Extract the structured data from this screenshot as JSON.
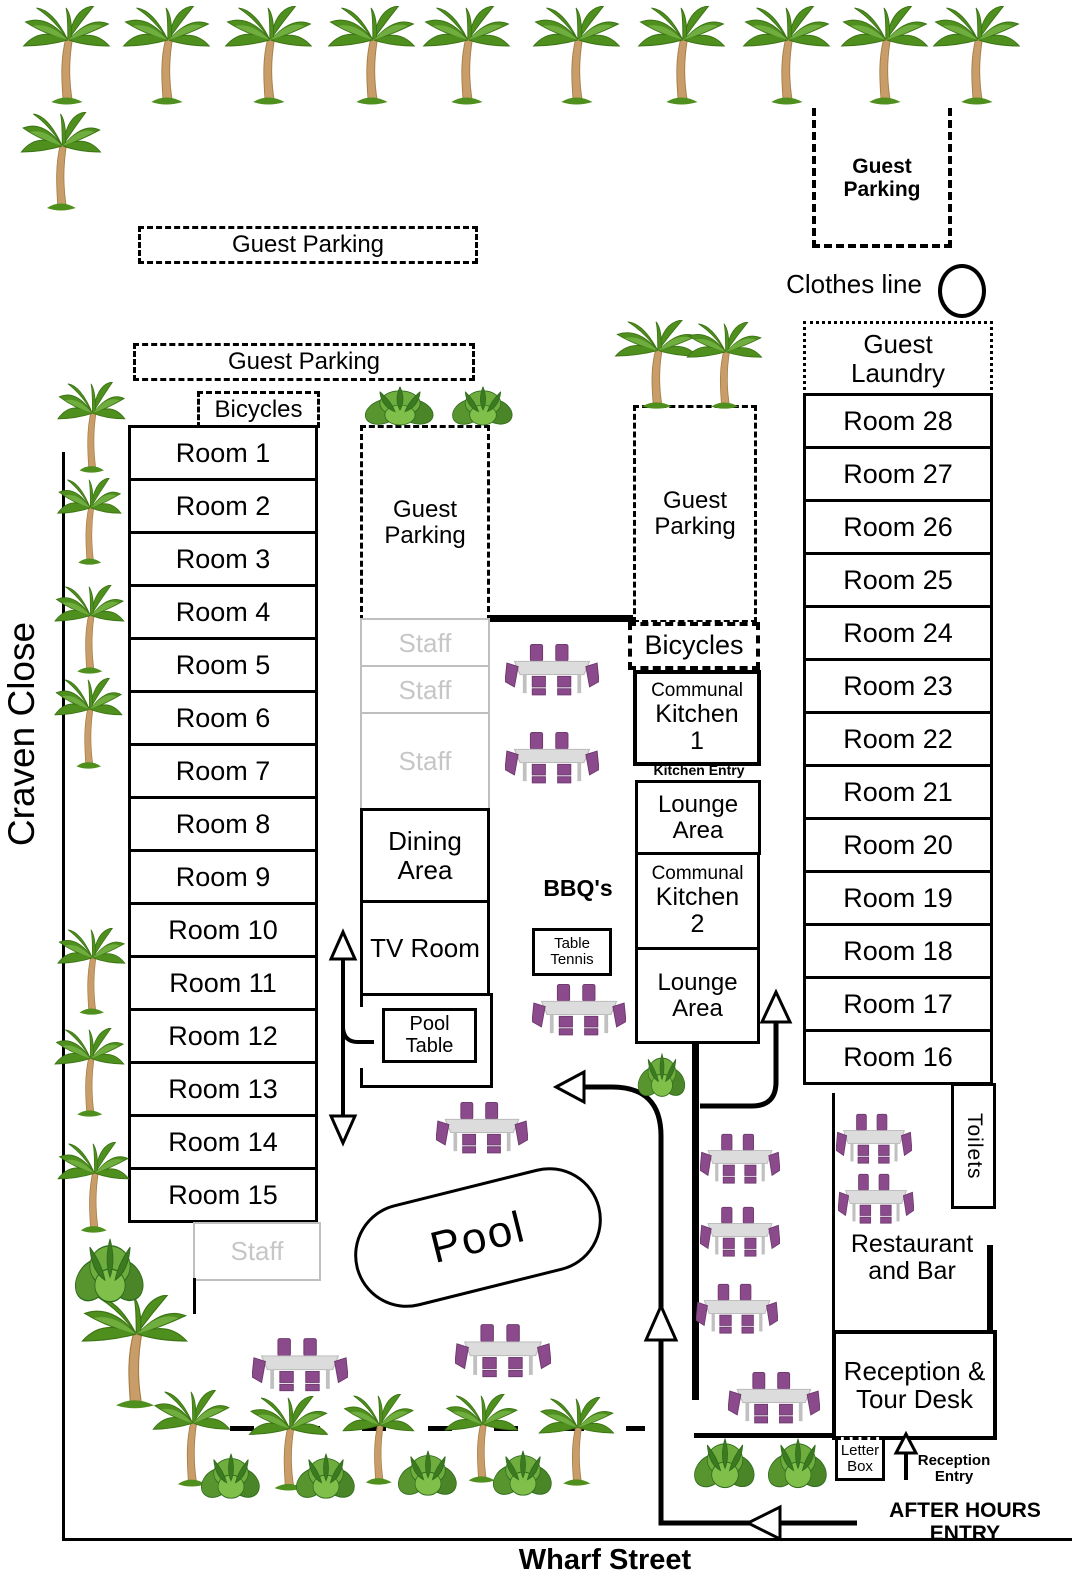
{
  "streets": {
    "craven_close": "Craven Close",
    "wharf_street": "Wharf Street"
  },
  "parking_label": "Guest Parking",
  "labels": {
    "clothes_line": "Clothes line",
    "guest_laundry": "Guest Laundry",
    "bicycles_left": "Bicycles",
    "bicycles_right": "Bicycles",
    "staff": "Staff",
    "dining_area": "Dining Area",
    "tv_room": "TV Room",
    "pool_table": "Pool Table",
    "pool": "Pool",
    "bbqs": "BBQ's",
    "table_tennis": "Table Tennis",
    "kitchen_entry": "Kitchen Entry",
    "lounge_area": "Lounge Area",
    "toilets": "Toilets",
    "restaurant": "Restaurant and Bar",
    "reception": "Reception & Tour Desk",
    "letter_box": "Letter Box",
    "reception_entry": "Reception Entry",
    "after_hours": "AFTER HOURS ENTRY"
  },
  "kitchen1": {
    "line1": "Communal",
    "line2": "Kitchen",
    "line3": "1"
  },
  "kitchen2": {
    "line1": "Communal",
    "line2": "Kitchen",
    "line3": "2"
  },
  "rooms_left": [
    "Room 1",
    "Room 2",
    "Room 3",
    "Room 4",
    "Room 5",
    "Room 6",
    "Room 7",
    "Room 8",
    "Room 9",
    "Room 10",
    "Room 11",
    "Room 12",
    "Room 13",
    "Room 14",
    "Room 15"
  ],
  "rooms_right": [
    "Room 28",
    "Room 27",
    "Room 26",
    "Room 25",
    "Room 24",
    "Room 23",
    "Room 22",
    "Room 21",
    "Room 20",
    "Room 19",
    "Room 18",
    "Room 17",
    "Room 16"
  ],
  "colors": {
    "line": "#000000",
    "staff_gray": "#c6c6c6",
    "table_purple": "#8b4a8b",
    "palm_leaf": "#4e8f1e",
    "palm_trunk": "#c99d6a"
  },
  "icons": {
    "palm": "palm-tree-icon",
    "shrub": "shrub-icon",
    "picnic_table": "picnic-table-icon",
    "clothes_line_loop": "clothes-line-loop-icon"
  }
}
